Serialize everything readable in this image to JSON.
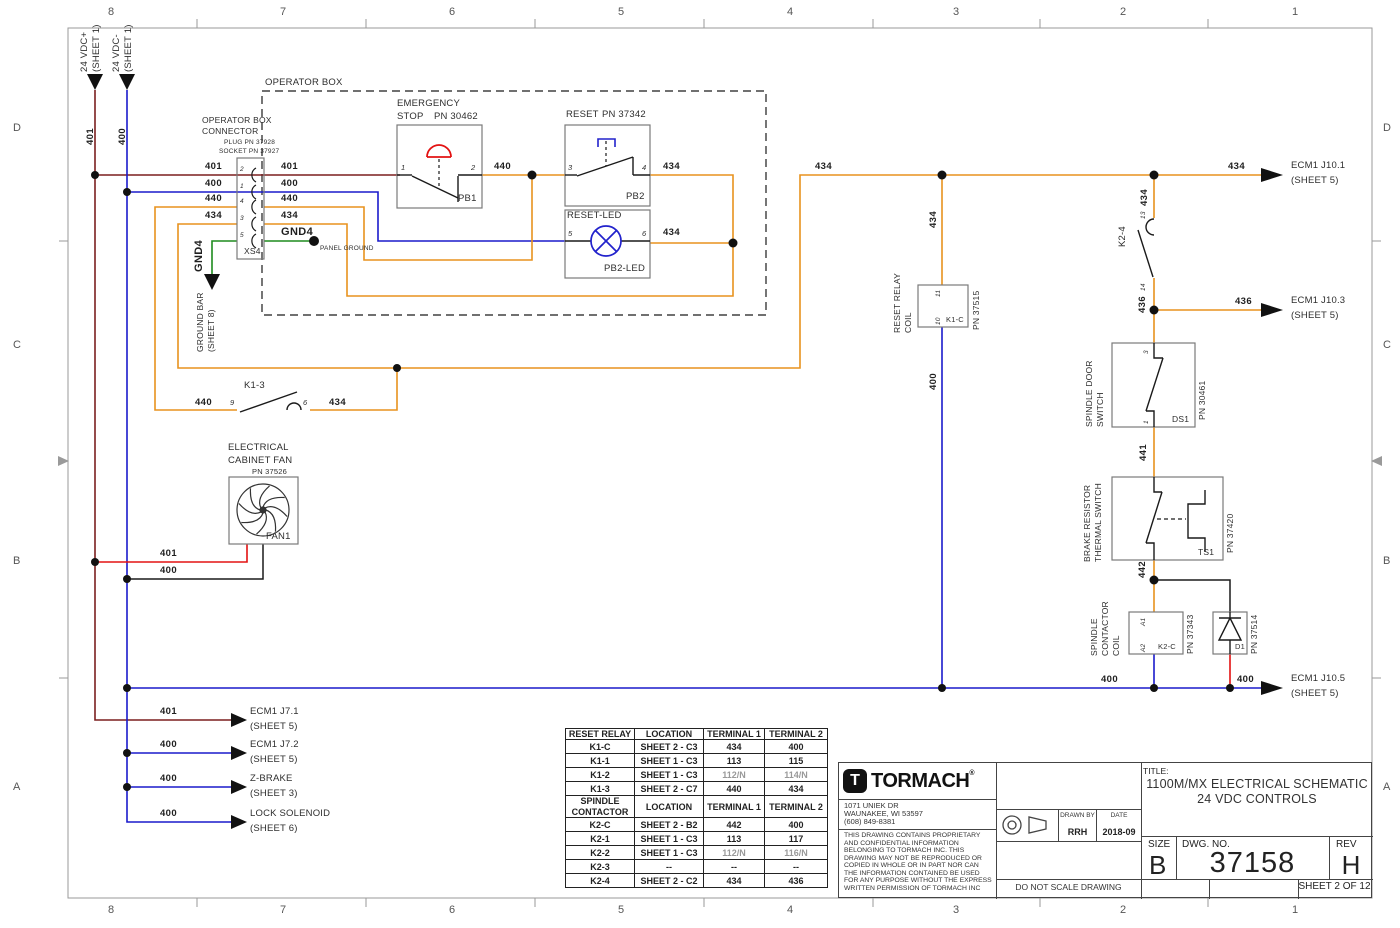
{
  "drawing": {
    "zones_top": [
      "8",
      "7",
      "6",
      "5",
      "4",
      "3",
      "2",
      "1"
    ],
    "zones_side": [
      "D",
      "C",
      "B",
      "A"
    ],
    "zone_x": [
      111,
      283,
      452,
      621,
      790,
      956,
      1123,
      1295
    ],
    "zone_y": [
      128,
      345,
      561,
      787
    ]
  },
  "title_block": {
    "company": "TORMACH",
    "reg": "®",
    "logo_letter": "T",
    "address": [
      "1071 UNIEK DR",
      "WAUNAKEE, WI 53597",
      "(608) 849-8381"
    ],
    "legal": [
      "THIS DRAWING CONTAINS PROPRIETARY",
      "AND CONFIDENTIAL INFORMATION",
      "BELONGING TO TORMACH INC. THIS",
      "DRAWING MAY NOT BE REPRODUCED OR",
      "COPIED IN WHOLE OR IN PART NOR CAN",
      "THE INFORMATION CONTAINED BE USED",
      "FOR ANY PURPOSE WITHOUT THE EXPRESS",
      "WRITTEN PERMISSION OF TORMACH INC"
    ],
    "drawn_by_label": "DRAWN BY",
    "drawn_by": "RRH",
    "date_label": "DATE",
    "date": "2018-09",
    "do_not_scale": "DO NOT SCALE DRAWING",
    "title_label": "TITLE:",
    "title_line1": "1100M/MX ELECTRICAL SCHEMATIC",
    "title_line2": "24 VDC CONTROLS",
    "size_label": "SIZE",
    "size": "B",
    "dwg_label": "DWG.  NO.",
    "dwg_no": "37158",
    "rev_label": "REV",
    "rev": "H",
    "sheet": "SHEET 2 OF 12"
  },
  "relay_table": {
    "x": 565,
    "y": 728,
    "col_widths": [
      68,
      68,
      60,
      62
    ],
    "sections": [
      {
        "header": [
          "RESET RELAY",
          "LOCATION",
          "TERMINAL 1",
          "TERMINAL 2"
        ],
        "rows": [
          [
            "K1-C",
            "SHEET 2 - C3",
            "434",
            "400"
          ],
          [
            "K1-1",
            "SHEET 1 - C3",
            "113",
            "115"
          ],
          [
            "K1-2",
            "SHEET 1 - C3",
            "112/N",
            "114/N"
          ],
          [
            "K1-3",
            "SHEET 2 - C7",
            "440",
            "434"
          ]
        ]
      },
      {
        "header": [
          "SPINDLE CONTACTOR",
          "LOCATION",
          "TERMINAL 1",
          "TERMINAL 2"
        ],
        "rows": [
          [
            "K2-C",
            "SHEET 2 - B2",
            "442",
            "400"
          ],
          [
            "K2-1",
            "SHEET 1 - C3",
            "113",
            "117"
          ],
          [
            "K2-2",
            "SHEET 1 - C3",
            "112/N",
            "116/N"
          ],
          [
            "K2-3",
            "--",
            "--",
            "--"
          ],
          [
            "K2-4",
            "SHEET 2 - C2",
            "434",
            "436"
          ]
        ]
      }
    ]
  },
  "schematic_labels": [
    {
      "n": "label-24vdc-plus",
      "t": "24 VDC+",
      "x": 80,
      "y": 72,
      "cls": "r s9"
    },
    {
      "n": "label-24vdc-plus-sheet",
      "t": "(SHEET 1)",
      "x": 92,
      "y": 72,
      "cls": "r s9"
    },
    {
      "n": "label-24vdc-minus",
      "t": "24 VDC-",
      "x": 112,
      "y": 72,
      "cls": "r s9"
    },
    {
      "n": "label-24vdc-minus-sheet",
      "t": "(SHEET 1)",
      "x": 124,
      "y": 72,
      "cls": "r s9"
    },
    {
      "n": "wire-401-top",
      "t": "401",
      "x": 86,
      "y": 145,
      "cls": "r wn"
    },
    {
      "n": "wire-400-top",
      "t": "400",
      "x": 118,
      "y": 145,
      "cls": "r wn"
    },
    {
      "n": "operator-box-title",
      "t": "OPERATOR BOX",
      "x": 265,
      "y": 78,
      "cls": "s9"
    },
    {
      "n": "connector-caption-1",
      "t": "OPERATOR BOX",
      "x": 202,
      "y": 116,
      "cls": "s8"
    },
    {
      "n": "connector-caption-2",
      "t": "CONNECTOR",
      "x": 202,
      "y": 127,
      "cls": "s8"
    },
    {
      "n": "connector-plug-pn",
      "t": "PLUG PN 37928",
      "x": 224,
      "y": 140,
      "cls": "s6"
    },
    {
      "n": "connector-socket-pn",
      "t": "SOCKET PN 37927",
      "x": 219,
      "y": 149,
      "cls": "s6"
    },
    {
      "n": "wire-401-conn-left",
      "t": "401",
      "x": 205,
      "y": 162,
      "cls": "wn"
    },
    {
      "n": "wire-400-conn-left",
      "t": "400",
      "x": 205,
      "y": 179,
      "cls": "wn"
    },
    {
      "n": "wire-440-conn-left",
      "t": "440",
      "x": 205,
      "y": 194,
      "cls": "wn"
    },
    {
      "n": "wire-434-conn-left",
      "t": "434",
      "x": 205,
      "y": 211,
      "cls": "wn"
    },
    {
      "n": "wire-401-conn-right",
      "t": "401",
      "x": 281,
      "y": 162,
      "cls": "wn"
    },
    {
      "n": "wire-400-conn-right",
      "t": "400",
      "x": 281,
      "y": 179,
      "cls": "wn"
    },
    {
      "n": "wire-440-conn-right",
      "t": "440",
      "x": 281,
      "y": 194,
      "cls": "wn"
    },
    {
      "n": "wire-434-conn-right",
      "t": "434",
      "x": 281,
      "y": 211,
      "cls": "wn"
    },
    {
      "n": "label-gnd4",
      "t": "GND4",
      "x": 281,
      "y": 227,
      "cls": "wn s11"
    },
    {
      "n": "label-panel-ground",
      "t": "PANEL GROUND",
      "x": 320,
      "y": 246,
      "cls": "s6"
    },
    {
      "n": "label-xs4",
      "t": "XS4",
      "x": 244,
      "y": 247,
      "cls": "s8"
    },
    {
      "n": "pin-conn-2",
      "t": "2",
      "x": 240,
      "y": 167,
      "cls": "s6 i"
    },
    {
      "n": "pin-conn-1",
      "t": "1",
      "x": 240,
      "y": 184,
      "cls": "s6 i"
    },
    {
      "n": "pin-conn-4",
      "t": "4",
      "x": 240,
      "y": 199,
      "cls": "s6 i"
    },
    {
      "n": "pin-conn-3",
      "t": "3",
      "x": 240,
      "y": 216,
      "cls": "s6 i"
    },
    {
      "n": "pin-conn-5",
      "t": "5",
      "x": 240,
      "y": 233,
      "cls": "s6 i"
    },
    {
      "n": "label-gnd4-rot",
      "t": "GND4",
      "x": 194,
      "y": 272,
      "cls": "r wn s11"
    },
    {
      "n": "label-ground-bar",
      "t": "GROUND BAR",
      "x": 196,
      "y": 352,
      "cls": "r s8"
    },
    {
      "n": "label-ground-bar-sheet",
      "t": "(SHEET 8)",
      "x": 207,
      "y": 352,
      "cls": "r s8"
    },
    {
      "n": "label-emergency",
      "t": "EMERGENCY",
      "x": 397,
      "y": 99,
      "cls": "s9"
    },
    {
      "n": "label-stop",
      "t": "STOP",
      "x": 397,
      "y": 112,
      "cls": "s9"
    },
    {
      "n": "label-pn-30462",
      "t": "PN 30462",
      "x": 434,
      "y": 112,
      "cls": "s9"
    },
    {
      "n": "label-pb1",
      "t": "PB1",
      "x": 458,
      "y": 194,
      "cls": "s9"
    },
    {
      "n": "pin-pb1-1",
      "t": "1",
      "x": 401,
      "y": 164,
      "cls": "s7 i"
    },
    {
      "n": "pin-pb1-2",
      "t": "2",
      "x": 471,
      "y": 164,
      "cls": "s7 i"
    },
    {
      "n": "wire-440-label",
      "t": "440",
      "x": 494,
      "y": 162,
      "cls": "wn"
    },
    {
      "n": "label-reset",
      "t": "RESET",
      "x": 566,
      "y": 110,
      "cls": "s9"
    },
    {
      "n": "label-pn-37342",
      "t": "PN 37342",
      "x": 602,
      "y": 110,
      "cls": "s9"
    },
    {
      "n": "label-pb2",
      "t": "PB2",
      "x": 626,
      "y": 192,
      "cls": "s9"
    },
    {
      "n": "pin-pb2-3",
      "t": "3",
      "x": 568,
      "y": 164,
      "cls": "s7 i"
    },
    {
      "n": "pin-pb2-4",
      "t": "4",
      "x": 642,
      "y": 164,
      "cls": "s7 i"
    },
    {
      "n": "wire-434-pb2",
      "t": "434",
      "x": 663,
      "y": 162,
      "cls": "wn"
    },
    {
      "n": "label-reset-led",
      "t": "RESET-LED",
      "x": 567,
      "y": 211,
      "cls": "s9"
    },
    {
      "n": "label-pb2-led",
      "t": "PB2-LED",
      "x": 604,
      "y": 264,
      "cls": "s9"
    },
    {
      "n": "pin-led-5",
      "t": "5",
      "x": 568,
      "y": 230,
      "cls": "s7 i"
    },
    {
      "n": "pin-led-6",
      "t": "6",
      "x": 642,
      "y": 230,
      "cls": "s7 i"
    },
    {
      "n": "wire-434-led",
      "t": "434",
      "x": 663,
      "y": 228,
      "cls": "wn"
    },
    {
      "n": "wire-434-run",
      "t": "434",
      "x": 815,
      "y": 162,
      "cls": "wn"
    },
    {
      "n": "wire-434-ecm",
      "t": "434",
      "x": 1228,
      "y": 162,
      "cls": "wn"
    },
    {
      "n": "ecm-j101-line1",
      "t": "ECM1 J10.1",
      "x": 1291,
      "y": 161,
      "cls": "s9"
    },
    {
      "n": "ecm-j101-line2",
      "t": "(SHEET 5)",
      "x": 1291,
      "y": 176,
      "cls": "s9"
    },
    {
      "n": "wire-434-coil-rot",
      "t": "434",
      "x": 929,
      "y": 228,
      "cls": "r wn"
    },
    {
      "n": "label-reset-relay-rot",
      "t": "RESET RELAY",
      "x": 893,
      "y": 333,
      "cls": "r s8"
    },
    {
      "n": "label-reset-coil-rot",
      "t": "COIL",
      "x": 904,
      "y": 333,
      "cls": "r s8"
    },
    {
      "n": "label-pn37515-rot",
      "t": "PN 37515",
      "x": 972,
      "y": 330,
      "cls": "r s8"
    },
    {
      "n": "label-k1c",
      "t": "K1-C",
      "x": 946,
      "y": 316,
      "cls": "s7"
    },
    {
      "n": "pin-coil-11",
      "t": "11",
      "x": 936,
      "y": 297,
      "cls": "r s6 i"
    },
    {
      "n": "pin-coil-10",
      "t": "10",
      "x": 936,
      "y": 325,
      "cls": "r s6 i"
    },
    {
      "n": "wire-400-coil-rot",
      "t": "400",
      "x": 929,
      "y": 390,
      "cls": "r wn"
    },
    {
      "n": "wire-434-k24-rot",
      "t": "434",
      "x": 1140,
      "y": 206,
      "cls": "r wn"
    },
    {
      "n": "pin-k24-13",
      "t": "13",
      "x": 1141,
      "y": 219,
      "cls": "r s6 i"
    },
    {
      "n": "label-k24-rot",
      "t": "K2-4",
      "x": 1118,
      "y": 247,
      "cls": "r s9"
    },
    {
      "n": "pin-k24-14",
      "t": "14",
      "x": 1141,
      "y": 291,
      "cls": "r s6 i"
    },
    {
      "n": "wire-436-rot",
      "t": "436",
      "x": 1138,
      "y": 313,
      "cls": "r wn"
    },
    {
      "n": "wire-436-ecm",
      "t": "436",
      "x": 1235,
      "y": 297,
      "cls": "wn"
    },
    {
      "n": "ecm-j103-line1",
      "t": "ECM1 J10.3",
      "x": 1291,
      "y": 296,
      "cls": "s9"
    },
    {
      "n": "ecm-j103-line2",
      "t": "(SHEET 5)",
      "x": 1291,
      "y": 311,
      "cls": "s9"
    },
    {
      "n": "label-spindle-door-rot",
      "t": "SPINDLE DOOR",
      "x": 1085,
      "y": 427,
      "cls": "r s8"
    },
    {
      "n": "label-door-switch-rot",
      "t": "SWITCH",
      "x": 1096,
      "y": 427,
      "cls": "r s8"
    },
    {
      "n": "label-pn30461-rot",
      "t": "PN 30461",
      "x": 1198,
      "y": 420,
      "cls": "r s8"
    },
    {
      "n": "label-ds1",
      "t": "DS1",
      "x": 1172,
      "y": 415,
      "cls": "s8"
    },
    {
      "n": "pin-ds1-3",
      "t": "3",
      "x": 1144,
      "y": 354,
      "cls": "r s6 i"
    },
    {
      "n": "pin-ds1-1",
      "t": "1",
      "x": 1144,
      "y": 424,
      "cls": "r s6 i"
    },
    {
      "n": "wire-441-rot",
      "t": "441",
      "x": 1139,
      "y": 461,
      "cls": "r wn"
    },
    {
      "n": "label-brake-resistor-rot",
      "t": "BRAKE RESISTOR",
      "x": 1083,
      "y": 562,
      "cls": "r s8"
    },
    {
      "n": "label-thermal-switch-rot",
      "t": "THERMAL SWITCH",
      "x": 1094,
      "y": 562,
      "cls": "r s8"
    },
    {
      "n": "label-pn37420-rot",
      "t": "PN 37420",
      "x": 1226,
      "y": 553,
      "cls": "r s8"
    },
    {
      "n": "label-ts1",
      "t": "TS1",
      "x": 1198,
      "y": 548,
      "cls": "s8"
    },
    {
      "n": "wire-442-rot",
      "t": "442",
      "x": 1138,
      "y": 578,
      "cls": "r wn"
    },
    {
      "n": "label-spindle-rot",
      "t": "SPINDLE",
      "x": 1090,
      "y": 656,
      "cls": "r s8"
    },
    {
      "n": "label-contactor-rot",
      "t": "CONTACTOR",
      "x": 1101,
      "y": 656,
      "cls": "r s8"
    },
    {
      "n": "label-contactor-coil-rot",
      "t": "COIL",
      "x": 1112,
      "y": 656,
      "cls": "r s8"
    },
    {
      "n": "pin-a1",
      "t": "A1",
      "x": 1141,
      "y": 626,
      "cls": "r s6 i"
    },
    {
      "n": "pin-a2",
      "t": "A2",
      "x": 1141,
      "y": 652,
      "cls": "r s6 i"
    },
    {
      "n": "label-k2c",
      "t": "K2-C",
      "x": 1158,
      "y": 643,
      "cls": "s7"
    },
    {
      "n": "label-pn37343-rot",
      "t": "PN 37343",
      "x": 1186,
      "y": 654,
      "cls": "r s8"
    },
    {
      "n": "label-d1",
      "t": "D1",
      "x": 1235,
      "y": 643,
      "cls": "s7"
    },
    {
      "n": "label-pn37514-rot",
      "t": "PN 37514",
      "x": 1250,
      "y": 654,
      "cls": "r s8"
    },
    {
      "n": "wire-400-bus-left",
      "t": "400",
      "x": 1101,
      "y": 675,
      "cls": "wn"
    },
    {
      "n": "wire-400-bus-right",
      "t": "400",
      "x": 1237,
      "y": 675,
      "cls": "wn"
    },
    {
      "n": "ecm-j105-line1",
      "t": "ECM1 J10.5",
      "x": 1291,
      "y": 674,
      "cls": "s9"
    },
    {
      "n": "ecm-j105-line2",
      "t": "(SHEET 5)",
      "x": 1291,
      "y": 689,
      "cls": "s9"
    },
    {
      "n": "label-k13",
      "t": "K1-3",
      "x": 244,
      "y": 381,
      "cls": "s9"
    },
    {
      "n": "wire-440-k13",
      "t": "440",
      "x": 195,
      "y": 398,
      "cls": "wn"
    },
    {
      "n": "pin-k13-9",
      "t": "9",
      "x": 230,
      "y": 399,
      "cls": "s7 i"
    },
    {
      "n": "pin-k13-6",
      "t": "6",
      "x": 303,
      "y": 399,
      "cls": "s7 i"
    },
    {
      "n": "wire-434-k13",
      "t": "434",
      "x": 329,
      "y": 398,
      "cls": "wn"
    },
    {
      "n": "label-electrical",
      "t": "ELECTRICAL",
      "x": 228,
      "y": 443,
      "cls": "s9"
    },
    {
      "n": "label-cabinet-fan",
      "t": "CABINET FAN",
      "x": 228,
      "y": 456,
      "cls": "s9"
    },
    {
      "n": "label-pn37526",
      "t": "PN 37526",
      "x": 252,
      "y": 468,
      "cls": "s7"
    },
    {
      "n": "label-fan1",
      "t": "FAN1",
      "x": 266,
      "y": 532,
      "cls": "s9"
    },
    {
      "n": "wire-401-fan",
      "t": "401",
      "x": 160,
      "y": 549,
      "cls": "wn"
    },
    {
      "n": "wire-400-fan",
      "t": "400",
      "x": 160,
      "y": 566,
      "cls": "wn"
    },
    {
      "n": "wire-401-j71",
      "t": "401",
      "x": 160,
      "y": 707,
      "cls": "wn"
    },
    {
      "n": "ecm-j71-line1",
      "t": "ECM1 J7.1",
      "x": 250,
      "y": 707,
      "cls": "s9"
    },
    {
      "n": "ecm-j71-line2",
      "t": "(SHEET 5)",
      "x": 250,
      "y": 722,
      "cls": "s9"
    },
    {
      "n": "wire-400-j72",
      "t": "400",
      "x": 160,
      "y": 740,
      "cls": "wn"
    },
    {
      "n": "ecm-j72-line1",
      "t": "ECM1 J7.2",
      "x": 250,
      "y": 740,
      "cls": "s9"
    },
    {
      "n": "ecm-j72-line2",
      "t": "(SHEET 5)",
      "x": 250,
      "y": 755,
      "cls": "s9"
    },
    {
      "n": "wire-400-zbrake",
      "t": "400",
      "x": 160,
      "y": 774,
      "cls": "wn"
    },
    {
      "n": "label-zbrake-line1",
      "t": "Z-BRAKE",
      "x": 250,
      "y": 774,
      "cls": "s9"
    },
    {
      "n": "label-zbrake-line2",
      "t": "(SHEET 3)",
      "x": 250,
      "y": 789,
      "cls": "s9"
    },
    {
      "n": "wire-400-lock",
      "t": "400",
      "x": 160,
      "y": 809,
      "cls": "wn"
    },
    {
      "n": "label-lock-line1",
      "t": "LOCK SOLENOID",
      "x": 250,
      "y": 809,
      "cls": "s9"
    },
    {
      "n": "label-lock-line2",
      "t": "(SHEET 6)",
      "x": 250,
      "y": 824,
      "cls": "s9"
    }
  ]
}
